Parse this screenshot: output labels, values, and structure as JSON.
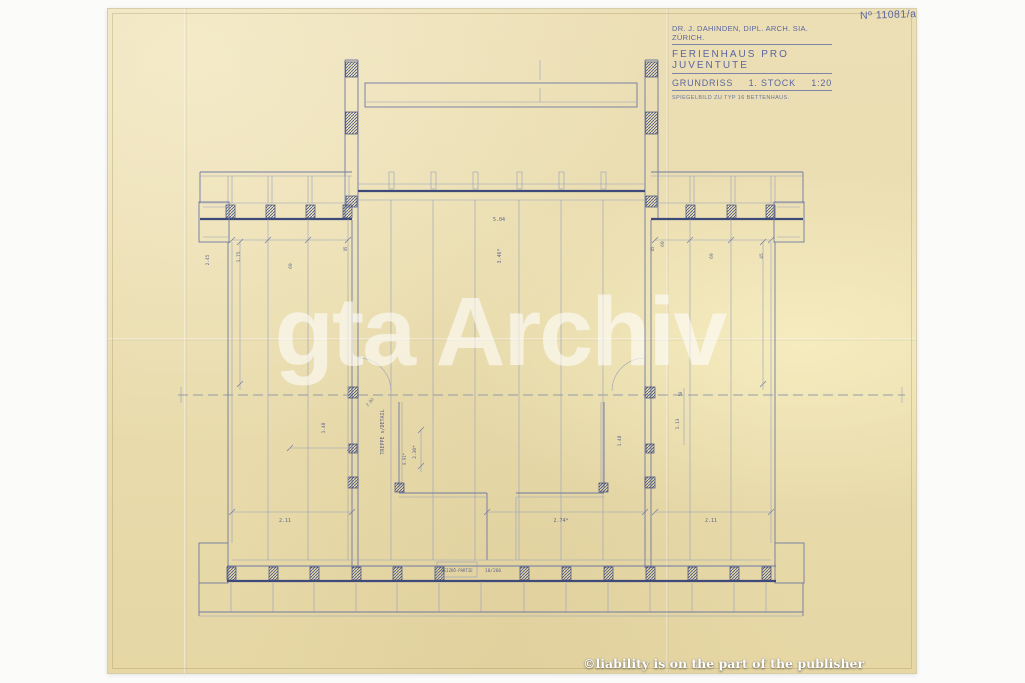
{
  "sheet": {
    "drawing_number": "Nº 11081/a"
  },
  "title_block": {
    "architect": "DR. J. DAHINDEN, DIPL. ARCH. SIA. ZÜRICH.",
    "project": "FERIENHAUS PRO JUVENTUTE",
    "drawing": "GRUNDRISS",
    "floor": "1. STOCK",
    "scale": "1:20",
    "note": "SPIEGELBILD ZU TYP 16 BETTENHAUS."
  },
  "watermarks": {
    "archive": "gta Archiv",
    "publisher": "©liability is on the part of the publisher"
  },
  "plan": {
    "dims": [
      {
        "t": "5.04",
        "x": 499,
        "y": 221,
        "r": 0,
        "s": 5
      },
      {
        "t": "3.46*",
        "x": 501,
        "y": 256,
        "r": -90,
        "s": 5
      },
      {
        "t": "2.45",
        "x": 209,
        "y": 260,
        "r": -90,
        "s": 4.5
      },
      {
        "t": "1.75",
        "x": 240,
        "y": 257,
        "r": -90,
        "s": 4.5
      },
      {
        "t": "69",
        "x": 292,
        "y": 266,
        "r": -90,
        "s": 4.5
      },
      {
        "t": "95",
        "x": 347,
        "y": 249,
        "r": -90,
        "s": 4
      },
      {
        "t": "85",
        "x": 654,
        "y": 249,
        "r": -90,
        "s": 4
      },
      {
        "t": "69",
        "x": 664,
        "y": 244,
        "r": -90,
        "s": 4.5
      },
      {
        "t": "69",
        "x": 713,
        "y": 256,
        "r": -90,
        "s": 4.5
      },
      {
        "t": "45",
        "x": 763,
        "y": 256,
        "r": -90,
        "s": 4.5
      },
      {
        "t": "2.02",
        "x": 371,
        "y": 403,
        "r": -50,
        "s": 4
      },
      {
        "t": "58",
        "x": 682,
        "y": 394,
        "r": -90,
        "s": 4
      },
      {
        "t": "1.48",
        "x": 325,
        "y": 428,
        "r": -90,
        "s": 4.5
      },
      {
        "t": "TREPPE s/DETAIL",
        "x": 384,
        "y": 432,
        "r": -90,
        "s": 5
      },
      {
        "t": "2.30*",
        "x": 416,
        "y": 452,
        "r": -90,
        "s": 4.5
      },
      {
        "t": "0.91*",
        "x": 406,
        "y": 459,
        "r": -90,
        "s": 4
      },
      {
        "t": "1.48",
        "x": 621,
        "y": 441,
        "r": -90,
        "s": 4.5
      },
      {
        "t": "1.13",
        "x": 679,
        "y": 424,
        "r": -90,
        "s": 4.5
      },
      {
        "t": "2.11",
        "x": 285,
        "y": 522,
        "r": 0,
        "s": 5
      },
      {
        "t": "2.74*",
        "x": 561,
        "y": 522,
        "r": 0,
        "s": 5
      },
      {
        "t": "2.11",
        "x": 711,
        "y": 522,
        "r": 0,
        "s": 5
      },
      {
        "t": "HEIZKÖ-PARTIE",
        "x": 457,
        "y": 572,
        "r": 0,
        "s": 4
      },
      {
        "t": "18/266",
        "x": 493,
        "y": 572,
        "r": 0,
        "s": 4.5
      }
    ]
  }
}
